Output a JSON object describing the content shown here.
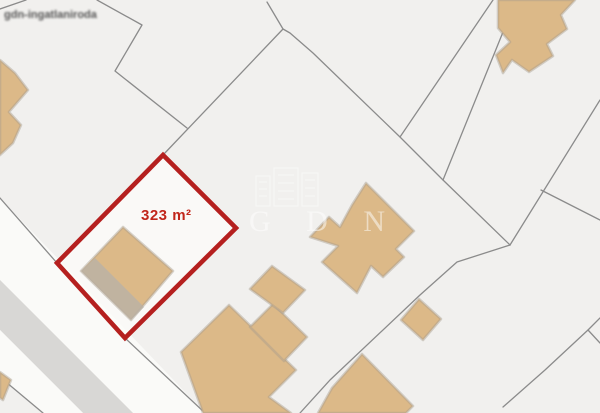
{
  "map": {
    "highlighted_parcel": {
      "area_label": "323 m²"
    },
    "watermarks": {
      "corner_text": "gdn-ingatlaniroda",
      "logo_letters": "G D N"
    },
    "colors": {
      "background": "#f1f0ee",
      "parcel_light": "#fafaf8",
      "road": "#d8d7d5",
      "parcel_line": "#8b8b8b",
      "building": "#dcb988",
      "building_outline": "#a99e8d",
      "highlight": "#b5201f",
      "label": "#c1261b",
      "watermark_dark": "#3a3a3a"
    }
  }
}
